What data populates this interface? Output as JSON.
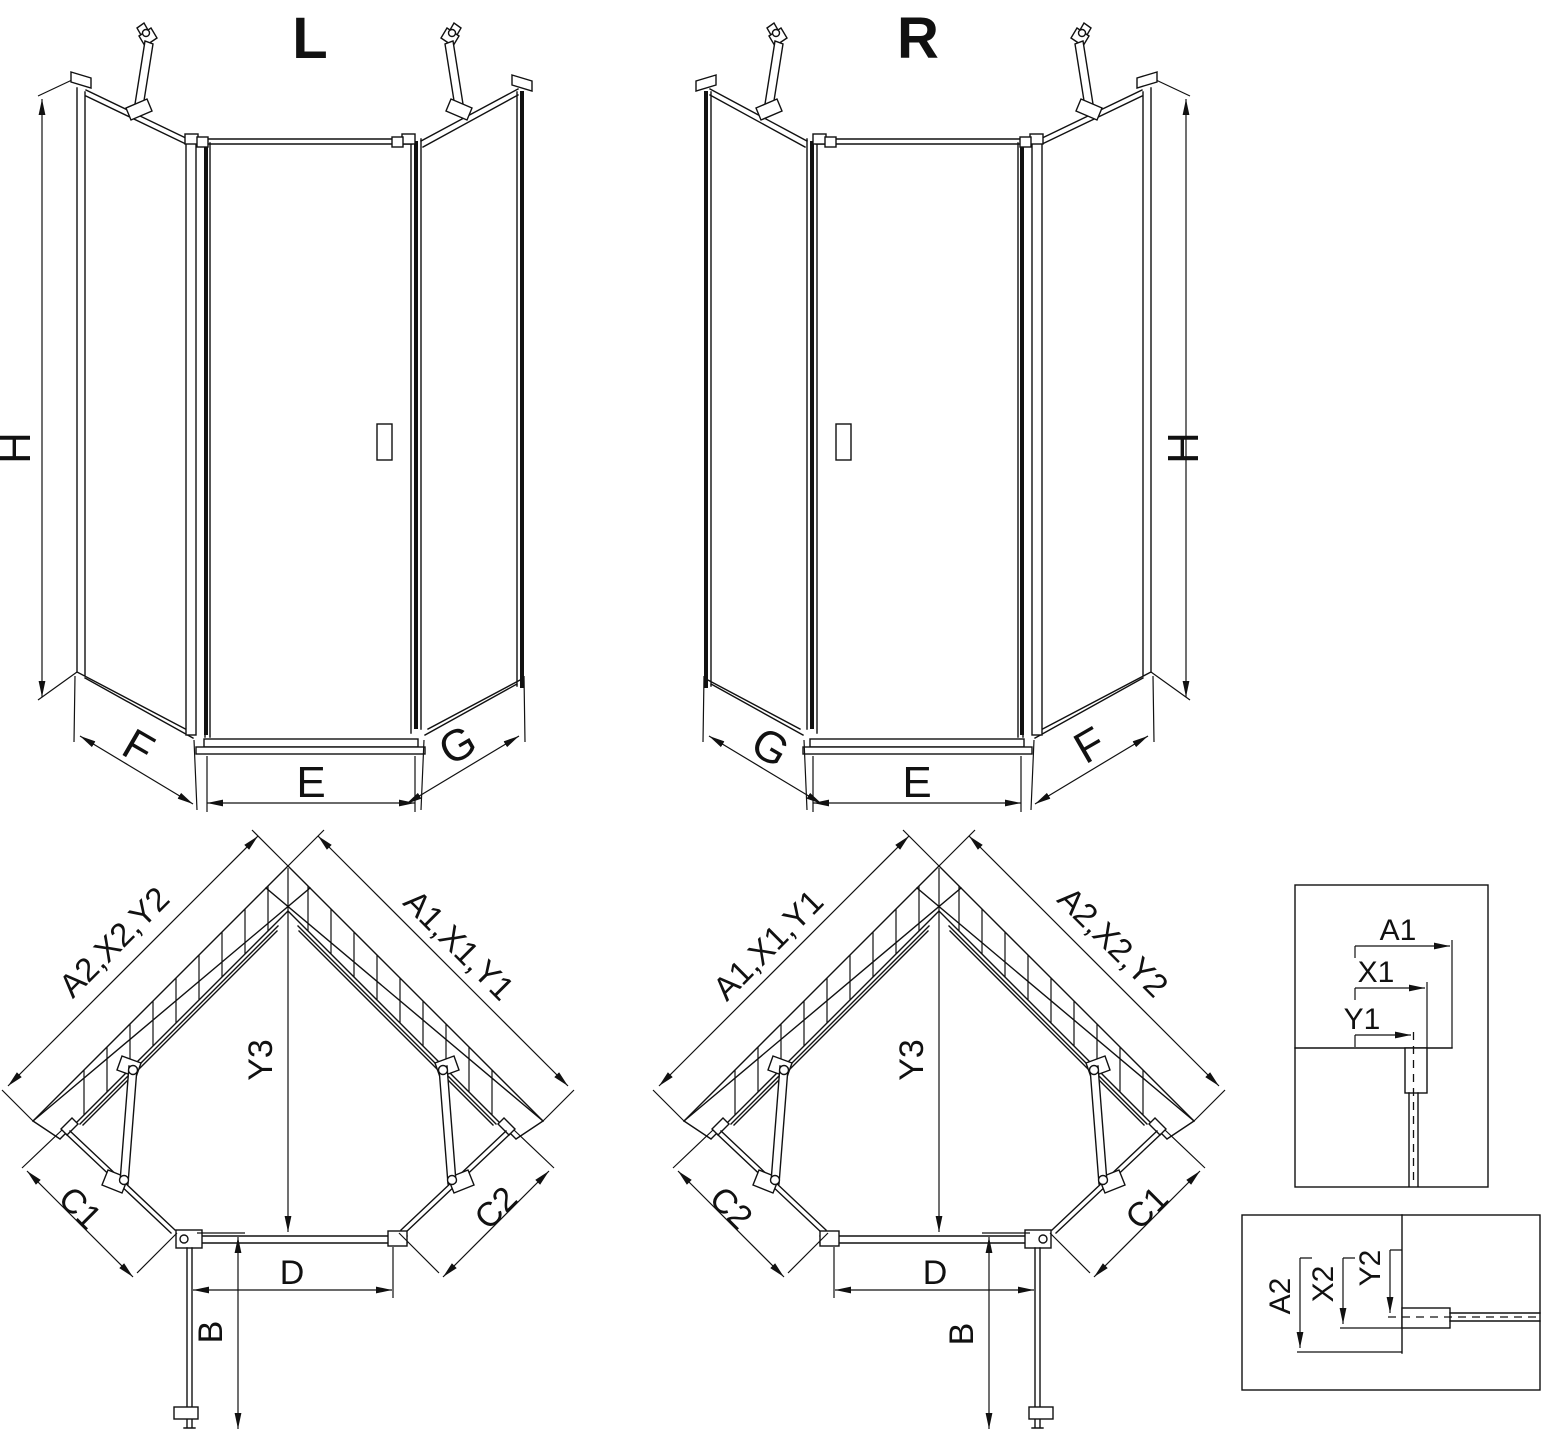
{
  "drawing": {
    "front_left": {
      "title": "L",
      "height": "H",
      "bottom_left": "F",
      "bottom_center": "E",
      "bottom_right": "G"
    },
    "front_right": {
      "title": "R",
      "height": "H",
      "bottom_left": "G",
      "bottom_center": "E",
      "bottom_right": "F"
    },
    "plan_left": {
      "wall_left": "A2,X2,Y2",
      "wall_right": "A1,X1,Y1",
      "center_depth": "Y3",
      "panel_left": "C1",
      "panel_right": "C2",
      "door_width": "D",
      "door_open": "B"
    },
    "plan_right": {
      "wall_left": "A1,X1,Y1",
      "wall_right": "A2,X2,Y2",
      "center_depth": "Y3",
      "panel_left": "C2",
      "panel_right": "C1",
      "door_width": "D",
      "door_open": "B"
    },
    "detail_top": {
      "d1": "A1",
      "d2": "X1",
      "d3": "Y1"
    },
    "detail_bottom": {
      "d1": "A2",
      "d2": "X2",
      "d3": "Y2"
    }
  },
  "colors": {
    "line": "#111111",
    "background": "#ffffff"
  }
}
